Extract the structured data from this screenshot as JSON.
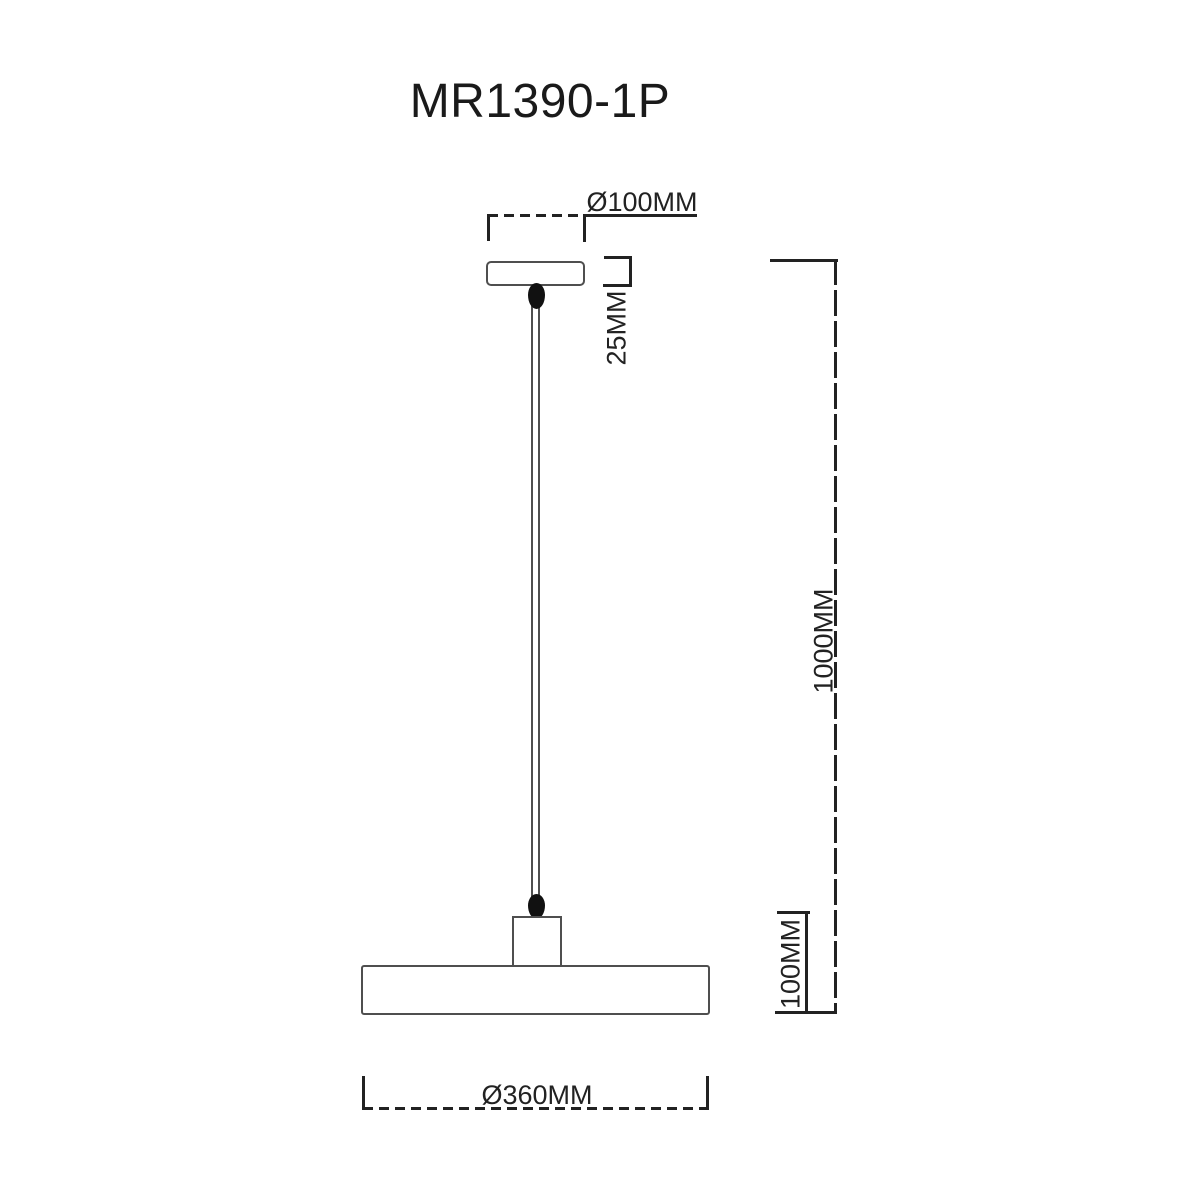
{
  "title": "MR1390-1P",
  "labels": {
    "canopy_diameter": "Ø100MM",
    "canopy_height": "25MM",
    "suspension_length": "1000MM",
    "shade_height": "100MM",
    "shade_diameter": "Ø360MM"
  },
  "colors": {
    "background": "#ffffff",
    "outline": "#4f4f4f",
    "dimension_lines": "#222222",
    "text": "#1a1a1a",
    "grip_fill": "#111111"
  }
}
